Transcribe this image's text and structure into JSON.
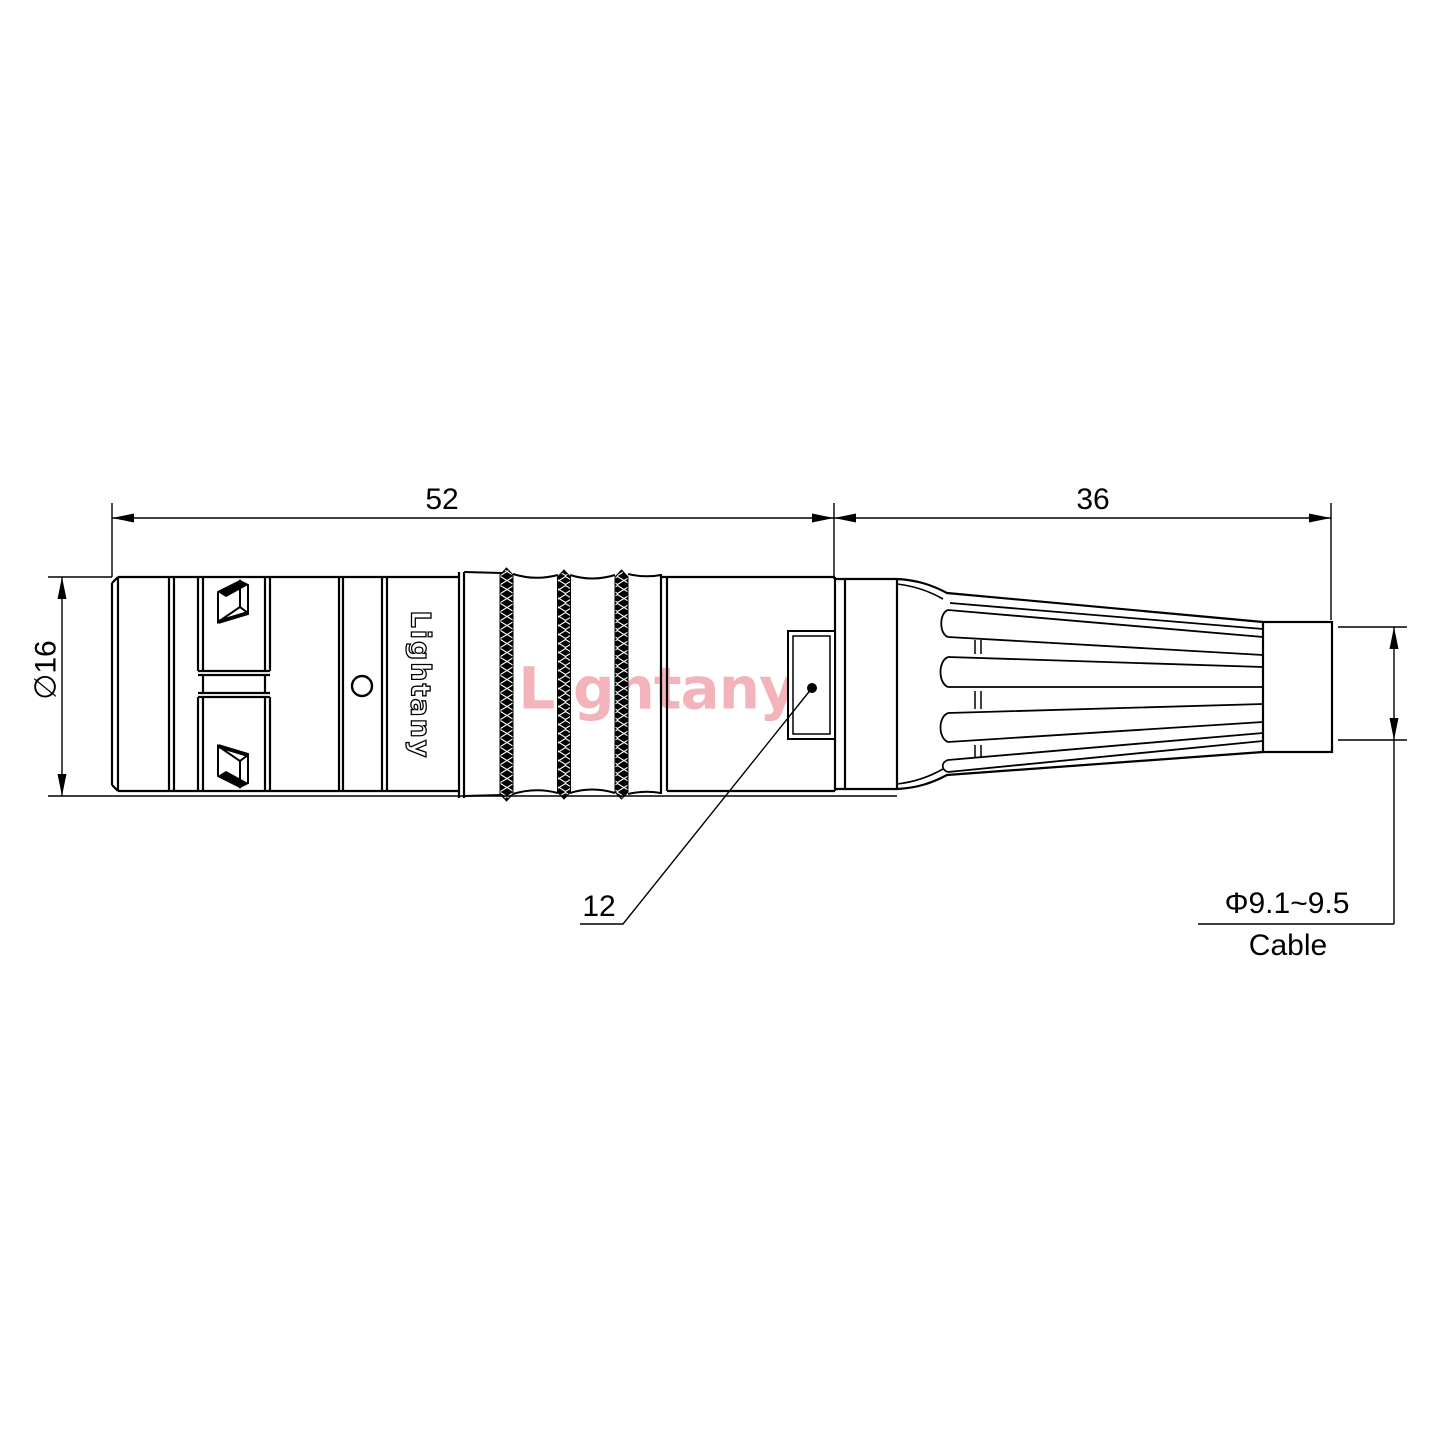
{
  "watermark": {
    "text": "Lightany",
    "color": "#f2b3ba"
  },
  "brand": {
    "label": "Lightany"
  },
  "dimensions": {
    "body_length": "52",
    "boot_length": "36",
    "body_diameter": "∅16",
    "window_size": "12",
    "cable_diameter": "Φ9.1~9.5",
    "cable_label": "Cable"
  },
  "colors": {
    "line": "#000000",
    "background": "#ffffff"
  }
}
